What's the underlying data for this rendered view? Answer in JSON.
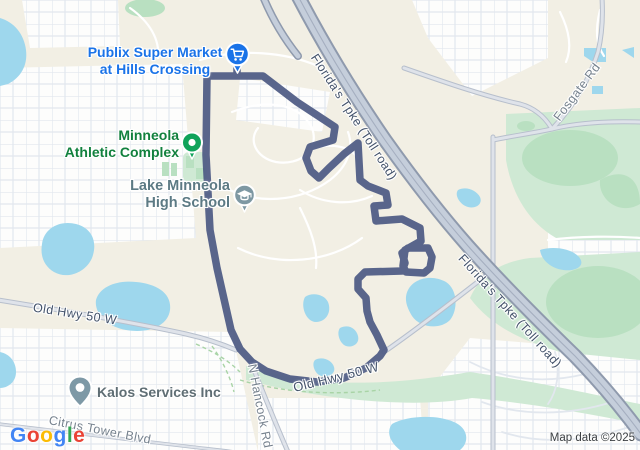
{
  "colors": {
    "base": "#f2efe4",
    "residential": "#fdfdfc",
    "grid-line": "#e2e7ee",
    "water": "#9ed7ed",
    "park-light": "#cfe9d4",
    "park-mid": "#b9e0c1",
    "route": "#4e5a84",
    "hwy-fill": "#c5cedb",
    "hwy-casing": "#8f9aad",
    "road-fill": "#dfe3ea",
    "road-casing": "#b7bfcc",
    "street-white": "#ffffff",
    "trail-green": "#a9d4a6",
    "label-road-major": "#44536b",
    "label-road-minor": "#76828e",
    "publix-blue": "#1a73e8",
    "athletic-green": "#12813e",
    "school-gray": "#5c7a84",
    "poi-gray": "#5f6e74",
    "pin-green": "#10a35a",
    "pin-school": "#7e98a3",
    "pin-kalos": "#7e99a6"
  },
  "pois": {
    "publix": {
      "line1": "Publix Super Market",
      "line2": "at Hills Crossing"
    },
    "athletic": {
      "line1": "Minneola",
      "line2": "Athletic Complex"
    },
    "school": {
      "line1": "Lake Minneola",
      "line2": "High School"
    },
    "kalos": {
      "label": "Kalos Services Inc"
    }
  },
  "road_labels": {
    "florida_tpke": "Florida's Tpke (Toll road)",
    "old_hwy_left": "Old Hwy 50 W",
    "old_hwy_bottom": "Old Hwy 50 W",
    "n_hancock": "N Hancock Rd",
    "citrus_tower": "Citrus Tower Blvd",
    "fosgate": "Fosgate Rd"
  },
  "logo": {
    "letters": [
      {
        "ch": "G",
        "style": "color:#4285F4"
      },
      {
        "ch": "o",
        "style": "color:#EA4335"
      },
      {
        "ch": "o",
        "style": "color:#FBBC04"
      },
      {
        "ch": "g",
        "style": "color:#4285F4"
      },
      {
        "ch": "l",
        "style": "color:#34A853"
      },
      {
        "ch": "e",
        "style": "color:#EA4335"
      }
    ]
  },
  "attribution": "Map data ©2025"
}
